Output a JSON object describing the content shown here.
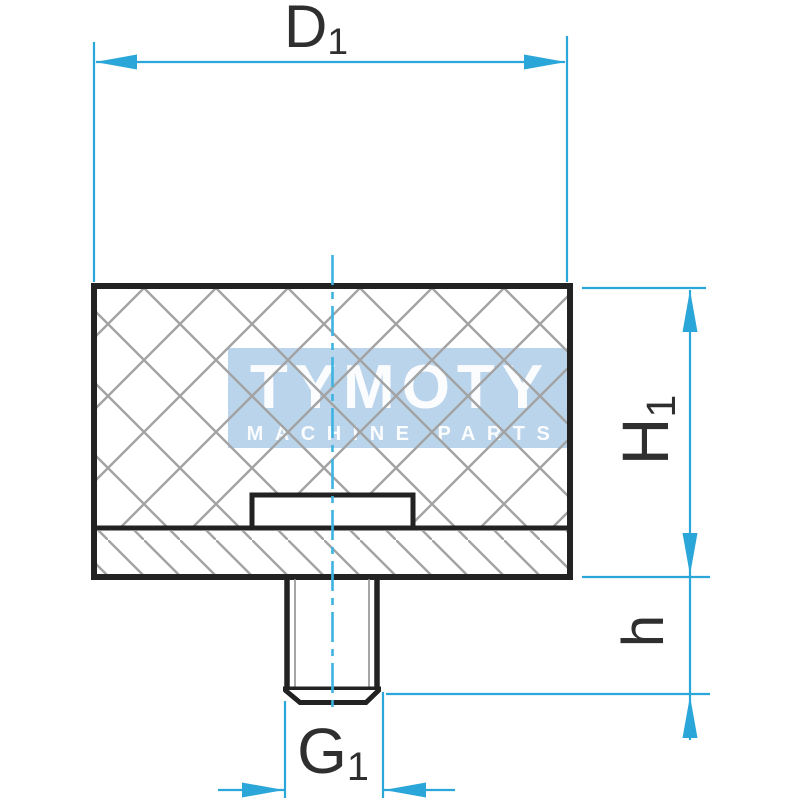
{
  "watermark": {
    "title": "TYMOTY",
    "subtitle": "MACHINE PARTS"
  },
  "dimensions": {
    "d1": {
      "main": "D",
      "sub": "1",
      "meaning": "outer-diameter"
    },
    "h1": {
      "main": "H",
      "sub": "1",
      "meaning": "body-height"
    },
    "h": {
      "main": "h",
      "sub": "",
      "meaning": "stud-length"
    },
    "g1": {
      "main": "G",
      "sub": "1",
      "meaning": "thread-diameter"
    }
  },
  "colors": {
    "dimension_accent": "#2aa6d9",
    "centerline": "#3db3e0",
    "outline": "#222222",
    "hatch": "#a3a3a3",
    "label_text": "#2f2f2f",
    "watermark_bg": "#b3cfe9",
    "watermark_text": "#ffffff"
  }
}
